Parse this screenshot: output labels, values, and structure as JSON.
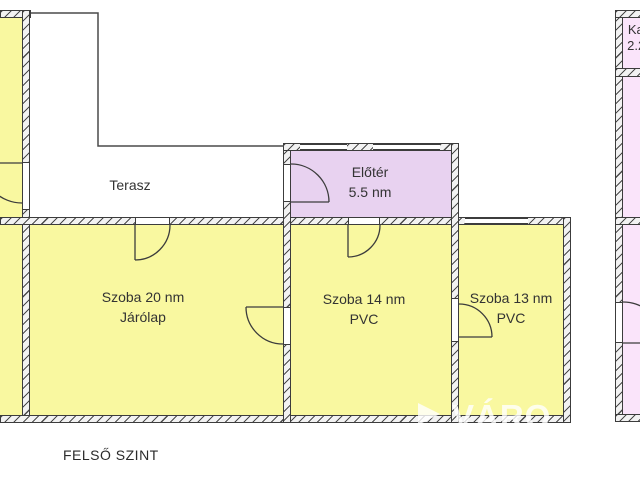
{
  "title": {
    "level": "FELSŐ SZINT"
  },
  "rooms": {
    "terasz": {
      "name": "Terasz"
    },
    "eloter": {
      "name": "Előtér",
      "area": "5.5 nm"
    },
    "szoba20": {
      "name": "Szoba 20 nm",
      "floor": "Járólap"
    },
    "szoba14": {
      "name": "Szoba 14 nm",
      "floor": "PVC"
    },
    "szoba13": {
      "name": "Szoba 13 nm",
      "floor": "PVC"
    },
    "kamra": {
      "name": "Kamra",
      "area": "2.2 nm"
    }
  },
  "watermark": {
    "text": "VÁRO",
    "icon": "play-triangle-icon"
  },
  "colors": {
    "room_yellow": "#f9f8a0",
    "room_pink": "#fae4fa",
    "room_lavender": "#e8d2f0",
    "wall_fill": "#f2f2f2",
    "wall_stroke": "#3c3c3c",
    "line": "#4a4a4a",
    "text_color": "#333333",
    "watermark": "rgba(255,255,255,0.8)"
  }
}
